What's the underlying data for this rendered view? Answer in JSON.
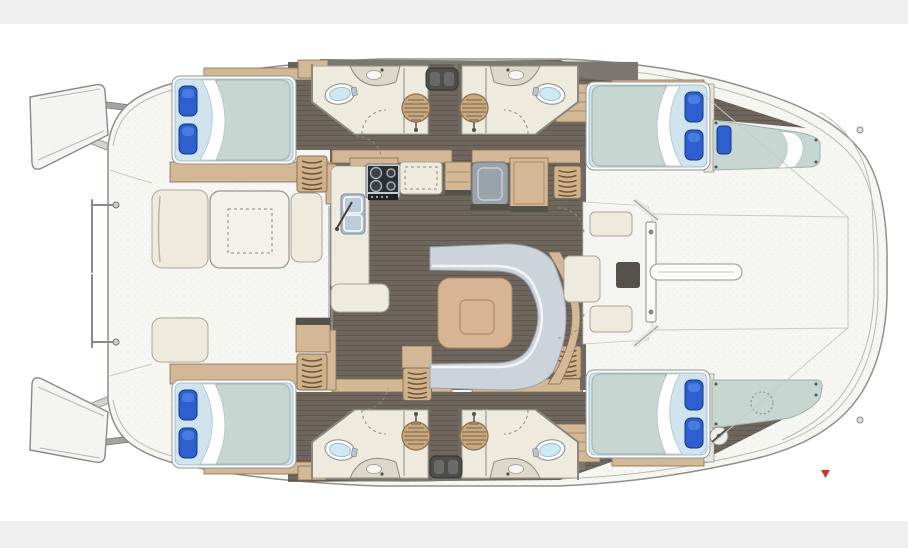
{
  "diagram": {
    "type": "yacht-floor-plan",
    "subject": "catamaran interior layout, plan view, bow to the right",
    "rooms": {
      "double_cabins": 4,
      "heads_with_shower": 4,
      "forepeak_berths": 2,
      "salon_with_c_sofa": 1,
      "galley": 1,
      "aft_cockpit_with_table": 1,
      "forward_lounge": 1
    },
    "furniture_counts": {
      "double_beds": 4,
      "blue_pillows": 10,
      "shower_grates": 4,
      "toilets": 4,
      "cockpit_tables": 1,
      "salon_tables": 1,
      "stoves": 1,
      "sinks_galley": 1,
      "fridges": 1,
      "step_ladders": 5
    }
  },
  "marker": {
    "shape": "small-red-triangle",
    "position": "lower-right-foredeck"
  },
  "colors": {
    "band": "#efefef",
    "deck": "#f6f6f3",
    "deckline": "#8f8f8d",
    "faint": "#b8b8b6",
    "graywalk": "#7b7872",
    "floor": "#6e665d",
    "wood": "#d2b896",
    "wooddark": "#8a6f52",
    "cream": "#eeeadd",
    "creamline": "#a9a59a",
    "walldark": "#6e6a62",
    "mattress": "#c7d6d1",
    "bedtrim": "#cfe4ef",
    "pillow": "#2c5fd0",
    "pillowdark": "#17367e",
    "sofa": "#ccd3da",
    "tablewood": "#d7b494",
    "toilet": "#cfe9f4",
    "grate": "#c8a87f",
    "grateline": "#8a6e50",
    "steel": "#9aa2ac",
    "stove": "#2c3033",
    "sink": "#a8bac8",
    "marker": "#cc3333"
  }
}
